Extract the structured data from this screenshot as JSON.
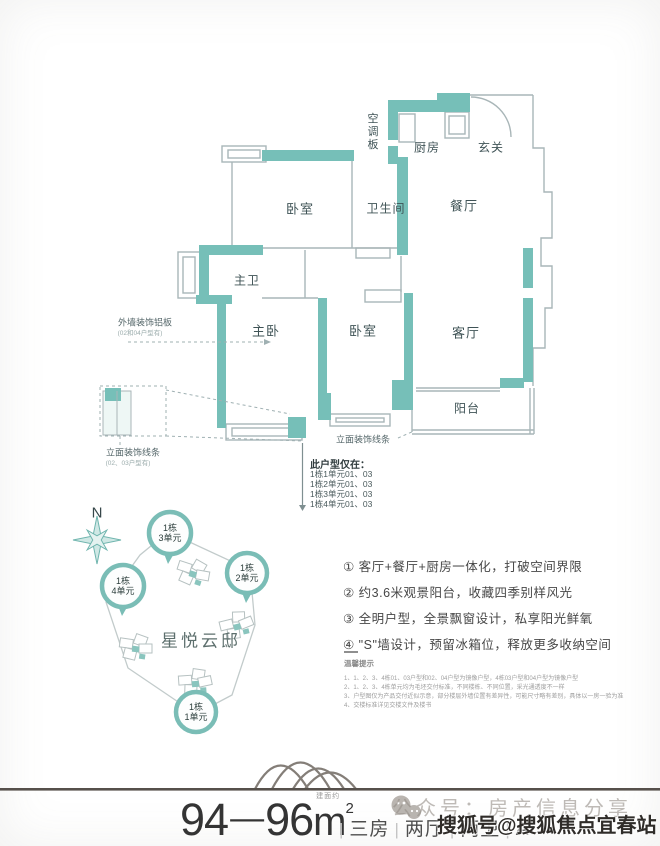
{
  "colors": {
    "wall_teal": "#76bfb8",
    "marker_ring": "#7abdb6",
    "thin_wall_gray": "#a9b6b8",
    "footer_rule": "#56504b"
  },
  "floor_plan": {
    "rooms": {
      "ac_panel": "空调板",
      "kitchen": "厨房",
      "entry": "玄关",
      "bedroom_top": "卧室",
      "bathroom": "卫生间",
      "dining": "餐厅",
      "master_bath": "主卫",
      "master_bedroom": "主卧",
      "bedroom_mid": "卧室",
      "living": "客厅",
      "balcony": "阳台"
    },
    "annotations": {
      "exterior_panel": "外墙装饰铝板",
      "exterior_panel_note": "(02和04户型有)",
      "facade_line_left": "立面装饰线条",
      "facade_line_left_note": "(02、03户型有)",
      "facade_line_mid": "立面装饰线条",
      "availability_title": "此户型仅在：",
      "availability_items": [
        "1栋1单元01、03",
        "1栋2单元01、03",
        "1栋3单元01、03",
        "1栋4单元01、03"
      ]
    }
  },
  "site_plan": {
    "compass_label": "N",
    "project_name": "星悦云邸",
    "markers": [
      {
        "line1": "1栋",
        "line2": "3单元"
      },
      {
        "line1": "1栋",
        "line2": "2单元"
      },
      {
        "line1": "1栋",
        "line2": "4单元"
      },
      {
        "line1": "1栋",
        "line2": "1单元"
      }
    ]
  },
  "features": {
    "items": [
      "① 客厅+餐厅+厨房一体化，打破空间界限",
      "② 约3.6米观景阳台，收藏四季别样风光",
      "③ 全明户型，全景飘窗设计，私享阳光鲜氧",
      "④ \"S\"墙设计，预留冰箱位，释放更多收纳空间"
    ]
  },
  "tips": {
    "title": "温馨提示",
    "lines": [
      "1、1、2、3、4栋01、03户型和02、04户型为镜像户型，4栋03户型和04户型为镜像户型",
      "2、1、2、3、4栋单元均为毛坯交付标准，不同楼栋、不同位置，采光通透度不一样",
      "3、户型图仅为产品交付近似示意，部分楼层外墙位置有差异性，可能尺寸略有差别，具体以一房一验为准",
      "4、交楼标准详见交楼文件及楼书"
    ]
  },
  "footer": {
    "area_min": "94",
    "area_dash": "—",
    "area_max": "96",
    "area_note": "建面约",
    "area_unit": "m",
    "area_sup": "2",
    "sep": "|",
    "specs": [
      "三房",
      "两厅",
      "两卫",
      "A"
    ],
    "wechat_watermark": "公众号：房产信息分享",
    "sohu_watermark": "搜狐号@搜狐焦点宜春站"
  }
}
